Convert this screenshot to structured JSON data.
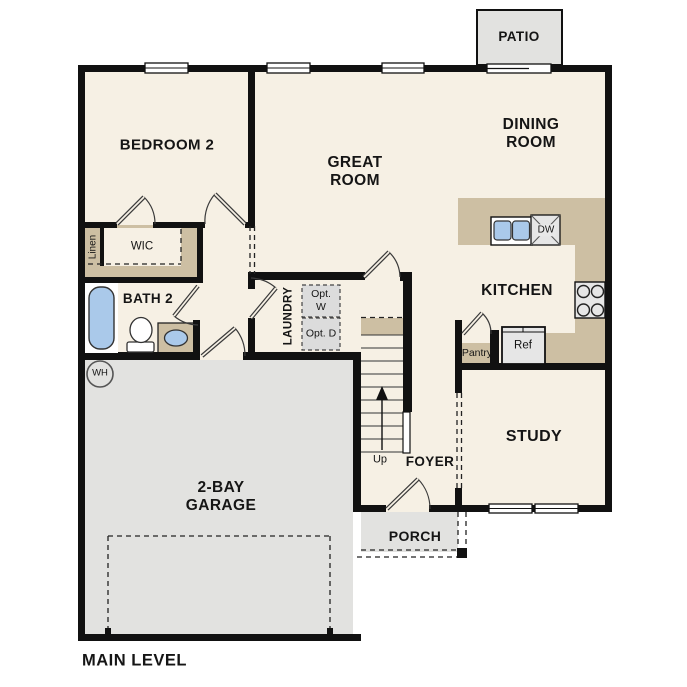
{
  "title": "MAIN LEVEL",
  "rooms": {
    "bedroom2": "BEDROOM 2",
    "great_room": "GREAT ROOM",
    "dining_room": "DINING ROOM",
    "kitchen": "KITCHEN",
    "study": "STUDY",
    "foyer": "FOYER",
    "garage": "2-BAY GARAGE",
    "bath2": "BATH 2",
    "laundry": "LAUNDRY",
    "wic": "WIC",
    "porch": "PORCH",
    "patio": "PATIO"
  },
  "labels": {
    "linen": "Linen",
    "pantry": "Pantry",
    "ref": "Ref",
    "dishwasher": "DW",
    "up": "Up",
    "water_heater": "WH",
    "opt_washer": "Opt. W",
    "opt_dryer": "Opt. D"
  },
  "colors": {
    "floor": "#f6f0e4",
    "surface": "#e2e2e0",
    "counter": "#cdbfa3",
    "wall": "#111111",
    "fixture": "#aac9ea",
    "optbox": "#dcdcdc",
    "appliance": "#e6e6e6"
  }
}
